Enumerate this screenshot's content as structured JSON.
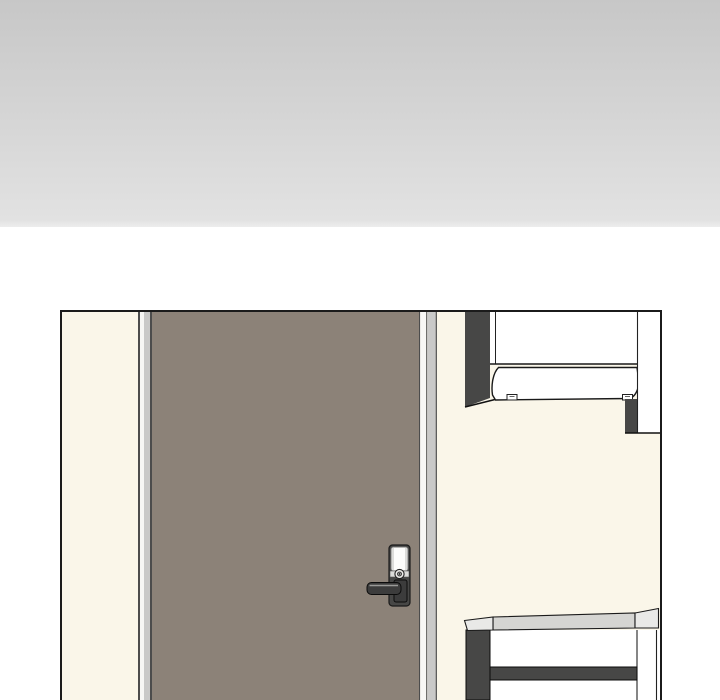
{
  "image": {
    "kind": "comic-panel-illustration",
    "description": "Webtoon background panel: closed taupe door with a digital lever lock in a cream wall; white wall cabinet with range-hood style front at top right; white table with dark legs and stretcher at bottom right; gray gradient block above the panel.",
    "visible_text": ""
  },
  "colors": {
    "page_bg": "#ffffff",
    "gradient_top": "#c7c7c7",
    "gradient_mid": "#d6d6d6",
    "gradient_bottom": "#e2e2e2",
    "panel_border": "#1b1b1b",
    "outline": "#1a1a1a",
    "wall": "#faf6e9",
    "door": "#8c8278",
    "frame_light": "#c9c9c8",
    "frame_line": "#4c4c4c",
    "dark": "#474746",
    "white": "#ffffff",
    "tabletop": "#d5d5d2",
    "tablecap": "#e9e9e7",
    "lock_plate": "#dcdcda",
    "lock_metal": "#3c3c3c"
  },
  "objects": {
    "fade_block": "gray gradient block (edge of previous panel)",
    "door": "closed door leaf",
    "door_frame": "door jamb strips",
    "door_lock": "digital door lock with lever handle and thumbturn",
    "wall_cabinet": "overhead wall cabinet with curved hood front and clips",
    "table": "table with tabletop, dark left leg, white right leg and dark stretcher"
  }
}
